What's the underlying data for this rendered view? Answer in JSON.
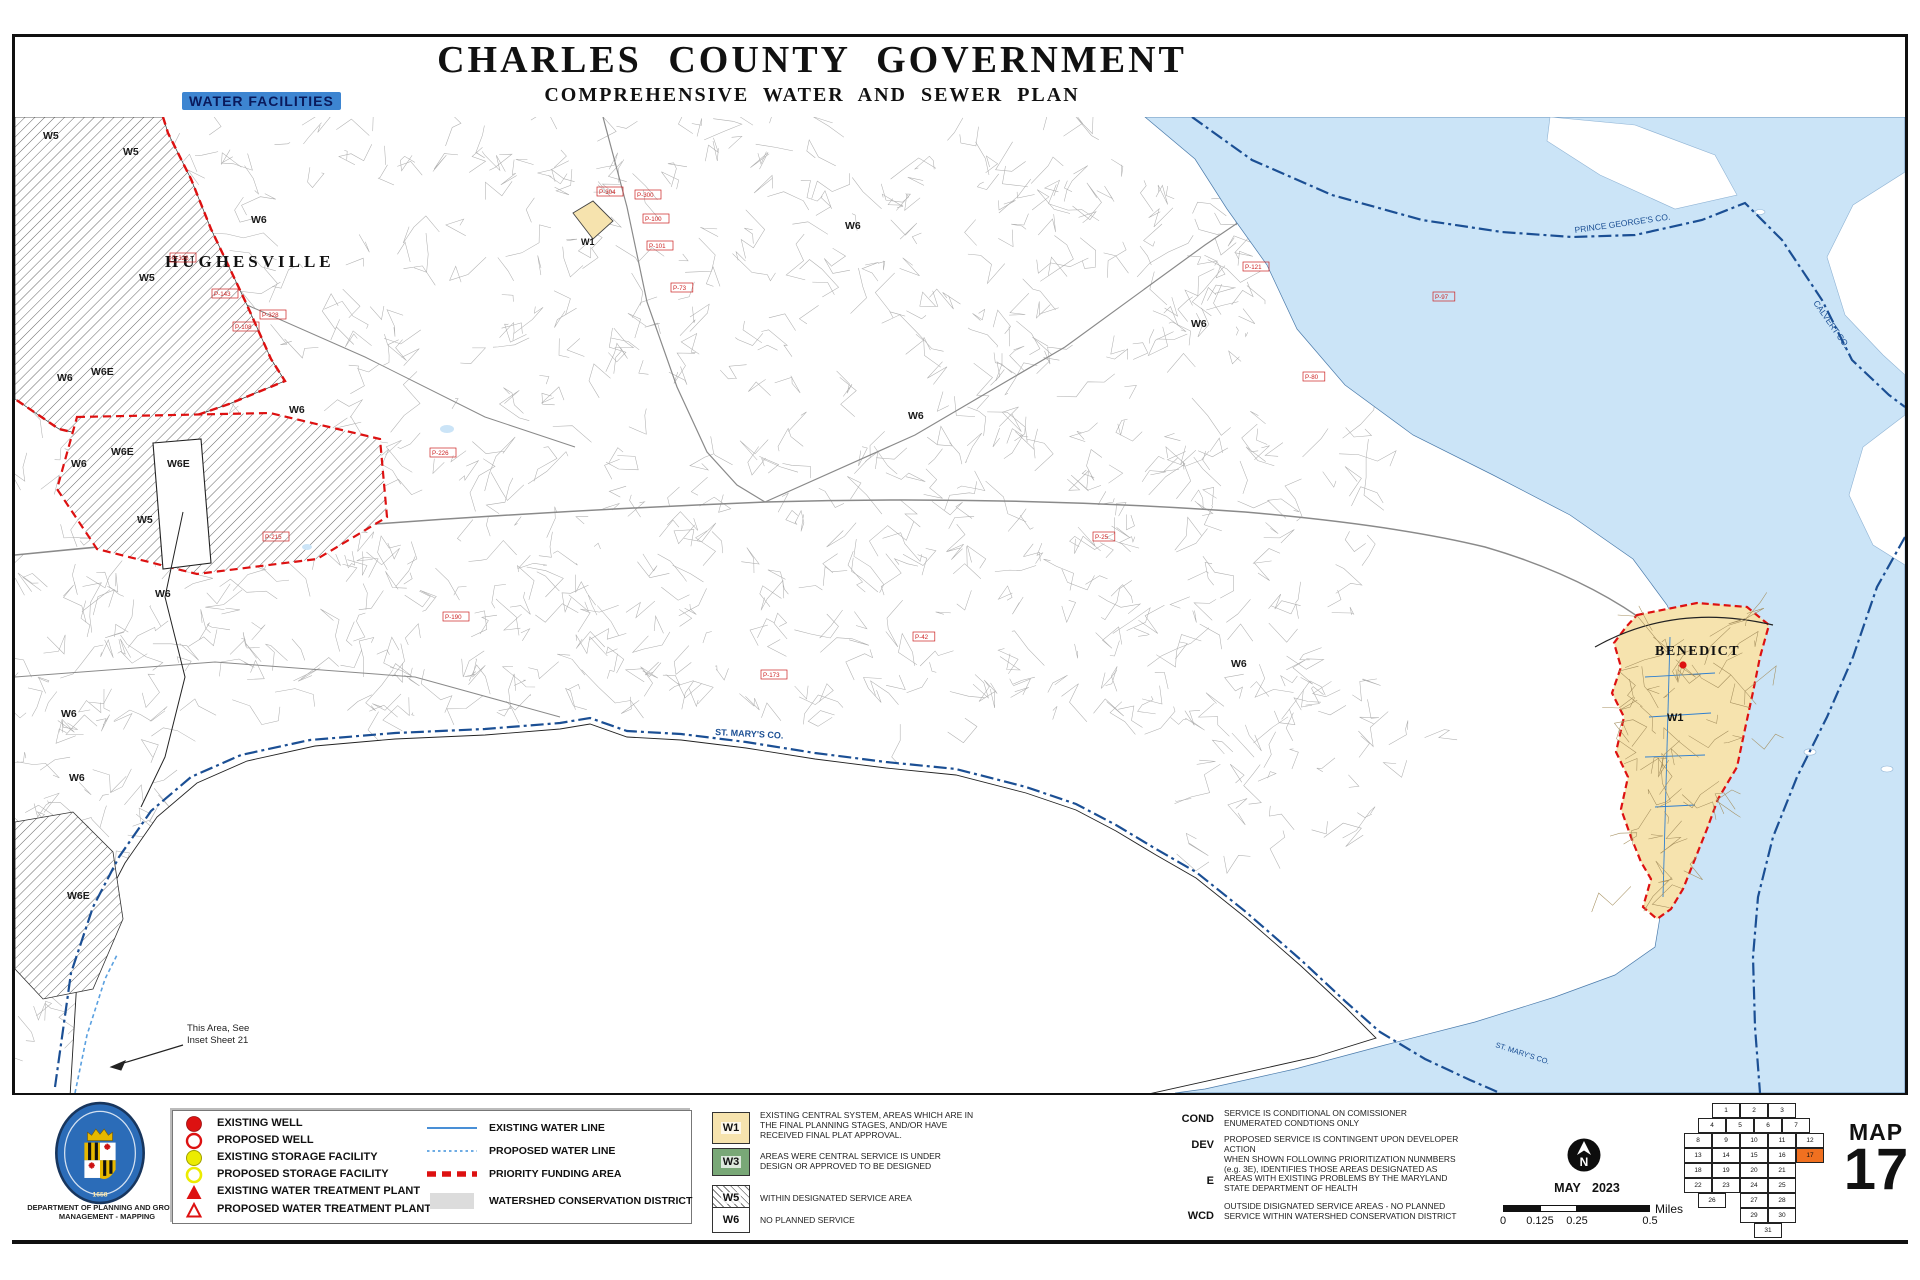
{
  "title": "CHARLES  COUNTY  GOVERNMENT",
  "subtitle": "COMPREHENSIVE  WATER  AND  SEWER  PLAN",
  "badge": "WATER FACILITIES",
  "agency_line1": "DEPARTMENT OF PLANNING AND GROWTH",
  "agency_line2": "MANAGEMENT - MAPPING",
  "map": {
    "hughesville": "HUGHESVILLE",
    "benedict": "BENEDICT",
    "st_marys": "ST. MARY'S CO.",
    "st_marys_2": "ST. MARY'S CO.",
    "prince_georges": "PRINCE GEORGE'S CO.",
    "calvert": "CALVERT CO.",
    "w1_diamond": "W1",
    "w1_benedict": "W1",
    "inset_note_line1": "This Area, See",
    "inset_note_line2": "Inset Sheet 21",
    "zone_scatter": [
      {
        "t": "W5",
        "x": 28,
        "y": 22
      },
      {
        "t": "W5",
        "x": 108,
        "y": 38
      },
      {
        "t": "W5",
        "x": 124,
        "y": 164
      },
      {
        "t": "W5",
        "x": 122,
        "y": 406
      },
      {
        "t": "W6",
        "x": 236,
        "y": 106
      },
      {
        "t": "W6",
        "x": 830,
        "y": 112
      },
      {
        "t": "W6",
        "x": 42,
        "y": 264
      },
      {
        "t": "W6",
        "x": 274,
        "y": 296
      },
      {
        "t": "W6",
        "x": 893,
        "y": 302
      },
      {
        "t": "W6",
        "x": 1176,
        "y": 210
      },
      {
        "t": "W6",
        "x": 1216,
        "y": 550
      },
      {
        "t": "W6",
        "x": 56,
        "y": 350
      },
      {
        "t": "W6",
        "x": 140,
        "y": 480
      },
      {
        "t": "W6",
        "x": 46,
        "y": 600
      },
      {
        "t": "W6",
        "x": 54,
        "y": 664
      },
      {
        "t": "W6E",
        "x": 96,
        "y": 338
      },
      {
        "t": "W6E",
        "x": 152,
        "y": 350
      },
      {
        "t": "W6E",
        "x": 52,
        "y": 782
      },
      {
        "t": "W6E",
        "x": 76,
        "y": 258
      }
    ],
    "parcel_ids": [
      {
        "t": "P-304",
        "x": 584,
        "y": 77
      },
      {
        "t": "P-300",
        "x": 622,
        "y": 80
      },
      {
        "t": "P-100",
        "x": 630,
        "y": 104
      },
      {
        "t": "P-101",
        "x": 634,
        "y": 131
      },
      {
        "t": "P-73",
        "x": 658,
        "y": 173
      },
      {
        "t": "P-226",
        "x": 417,
        "y": 338
      },
      {
        "t": "P-326",
        "x": 157,
        "y": 143
      },
      {
        "t": "P-143",
        "x": 199,
        "y": 179
      },
      {
        "t": "P-328",
        "x": 247,
        "y": 200
      },
      {
        "t": "P-108",
        "x": 220,
        "y": 212
      },
      {
        "t": "P-215",
        "x": 250,
        "y": 422
      },
      {
        "t": "P-190",
        "x": 430,
        "y": 502
      },
      {
        "t": "P-121",
        "x": 1230,
        "y": 152
      },
      {
        "t": "P-80",
        "x": 1290,
        "y": 262
      },
      {
        "t": "P-25",
        "x": 1080,
        "y": 422
      },
      {
        "t": "P-42",
        "x": 900,
        "y": 522
      },
      {
        "t": "P-97",
        "x": 1420,
        "y": 182
      },
      {
        "t": "P-173",
        "x": 748,
        "y": 560
      }
    ]
  },
  "legend": {
    "symbols": [
      {
        "symbol": "well_existing",
        "label": "EXISTING WELL"
      },
      {
        "symbol": "well_proposed",
        "label": "PROPOSED WELL"
      },
      {
        "symbol": "storage_existing",
        "label": "EXISTING STORAGE FACILITY"
      },
      {
        "symbol": "storage_proposed",
        "label": "PROPOSED STORAGE FACILITY"
      },
      {
        "symbol": "wtp_existing",
        "label": "EXISTING WATER TREATMENT PLANT"
      },
      {
        "symbol": "wtp_proposed",
        "label": "PROPOSED WATER TREATMENT PLANT"
      }
    ],
    "lines": [
      {
        "symbol": "line_existing",
        "label": "EXISTING WATER LINE"
      },
      {
        "symbol": "line_proposed",
        "label": "PROPOSED WATER LINE"
      },
      {
        "symbol": "pfa",
        "label": "PRIORITY FUNDING AREA"
      },
      {
        "symbol": "wcd",
        "label": "WATERSHED CONSERVATION DISTRICT"
      }
    ]
  },
  "zones": [
    {
      "code": "W1",
      "fill": "#f6e3ae",
      "desc": "EXISTING CENTRAL SYSTEM, AREAS WHICH ARE IN THE FINAL PLANNING STAGES, AND/OR HAVE RECEIVED FINAL PLAT APPROVAL."
    },
    {
      "code": "W3",
      "fill": "#79a877",
      "desc": "AREAS WERE CENTRAL SERVICE IS UNDER DESIGN OR APPROVED TO BE DESIGNED"
    },
    {
      "code": "W5",
      "fill": "hatch",
      "desc": "WITHIN DESIGNATED SERVICE AREA"
    },
    {
      "code": "W6",
      "fill": "#ffffff",
      "desc": "NO PLANNED SERVICE"
    }
  ],
  "definitions": [
    {
      "abbr": "COND",
      "text": "SERVICE IS CONDITIONAL ON COMISSIONER ENUMERATED  CONDTIONS  ONLY"
    },
    {
      "abbr": "DEV",
      "text": "PROPOSED SERVICE IS CONTINGENT UPON  DEVELOPER  ACTION"
    },
    {
      "abbr": "E",
      "text": "WHEN SHOWN FOLLOWING PRIORITIZATION NUNMBERS (e.g. 3E), IDENTIFIES THOSE AREAS DESIGNATED AS AREAS WITH EXISTING PROBLEMS BY THE MARYLAND STATE DEPARTMENT OF HEALTH"
    },
    {
      "abbr": "WCD",
      "text": "OUTSIDE  DISIGNATED  SERVICE  AREAS - NO PLANNED SERVICE  WITHIN  WATERSHED CONSERVATION  DISTRICT"
    }
  ],
  "north_letter": "N",
  "date": "MAY 2023",
  "scale": {
    "ticks": [
      "0",
      "0.125",
      "0.25",
      "0.5"
    ],
    "unit": "Miles"
  },
  "map_index": {
    "label": "MAP",
    "number": "17",
    "highlight": "17",
    "rows": [
      [
        {
          "n": "1",
          "c": 1
        },
        {
          "n": "2",
          "c": 2
        },
        {
          "n": "3",
          "c": 3
        }
      ],
      [
        {
          "n": "4",
          "c": 0.5
        },
        {
          "n": "5",
          "c": 1.5
        },
        {
          "n": "6",
          "c": 2.5
        },
        {
          "n": "7",
          "c": 3.5
        }
      ],
      [
        {
          "n": "8",
          "c": 0
        },
        {
          "n": "9",
          "c": 1
        },
        {
          "n": "10",
          "c": 2
        },
        {
          "n": "11",
          "c": 3
        },
        {
          "n": "12",
          "c": 4
        }
      ],
      [
        {
          "n": "13",
          "c": 0
        },
        {
          "n": "14",
          "c": 1
        },
        {
          "n": "15",
          "c": 2
        },
        {
          "n": "16",
          "c": 3
        },
        {
          "n": "17",
          "c": 4
        }
      ],
      [
        {
          "n": "18",
          "c": 0
        },
        {
          "n": "19",
          "c": 1
        },
        {
          "n": "20",
          "c": 2
        },
        {
          "n": "21",
          "c": 3
        }
      ],
      [
        {
          "n": "22",
          "c": 0
        },
        {
          "n": "23",
          "c": 1
        },
        {
          "n": "24",
          "c": 2
        },
        {
          "n": "25",
          "c": 3
        }
      ],
      [
        {
          "n": "26",
          "c": 0.5
        },
        {
          "n": "27",
          "c": 2
        },
        {
          "n": "28",
          "c": 3
        }
      ],
      [
        {
          "n": "29",
          "c": 2
        },
        {
          "n": "30",
          "c": 3
        }
      ],
      [
        {
          "n": "31",
          "c": 2.5
        }
      ]
    ]
  },
  "colors": {
    "water": "#cbe4f7",
    "w1_tan": "#f6e3ae",
    "w3_green": "#79a877",
    "red": "#dd1111",
    "county_line": "#1b4f94",
    "water_line": "#2f7fd0",
    "index_highlight": "#f07020",
    "seal_blue": "#2b6cb8",
    "badge_blue": "#3d85d1"
  }
}
